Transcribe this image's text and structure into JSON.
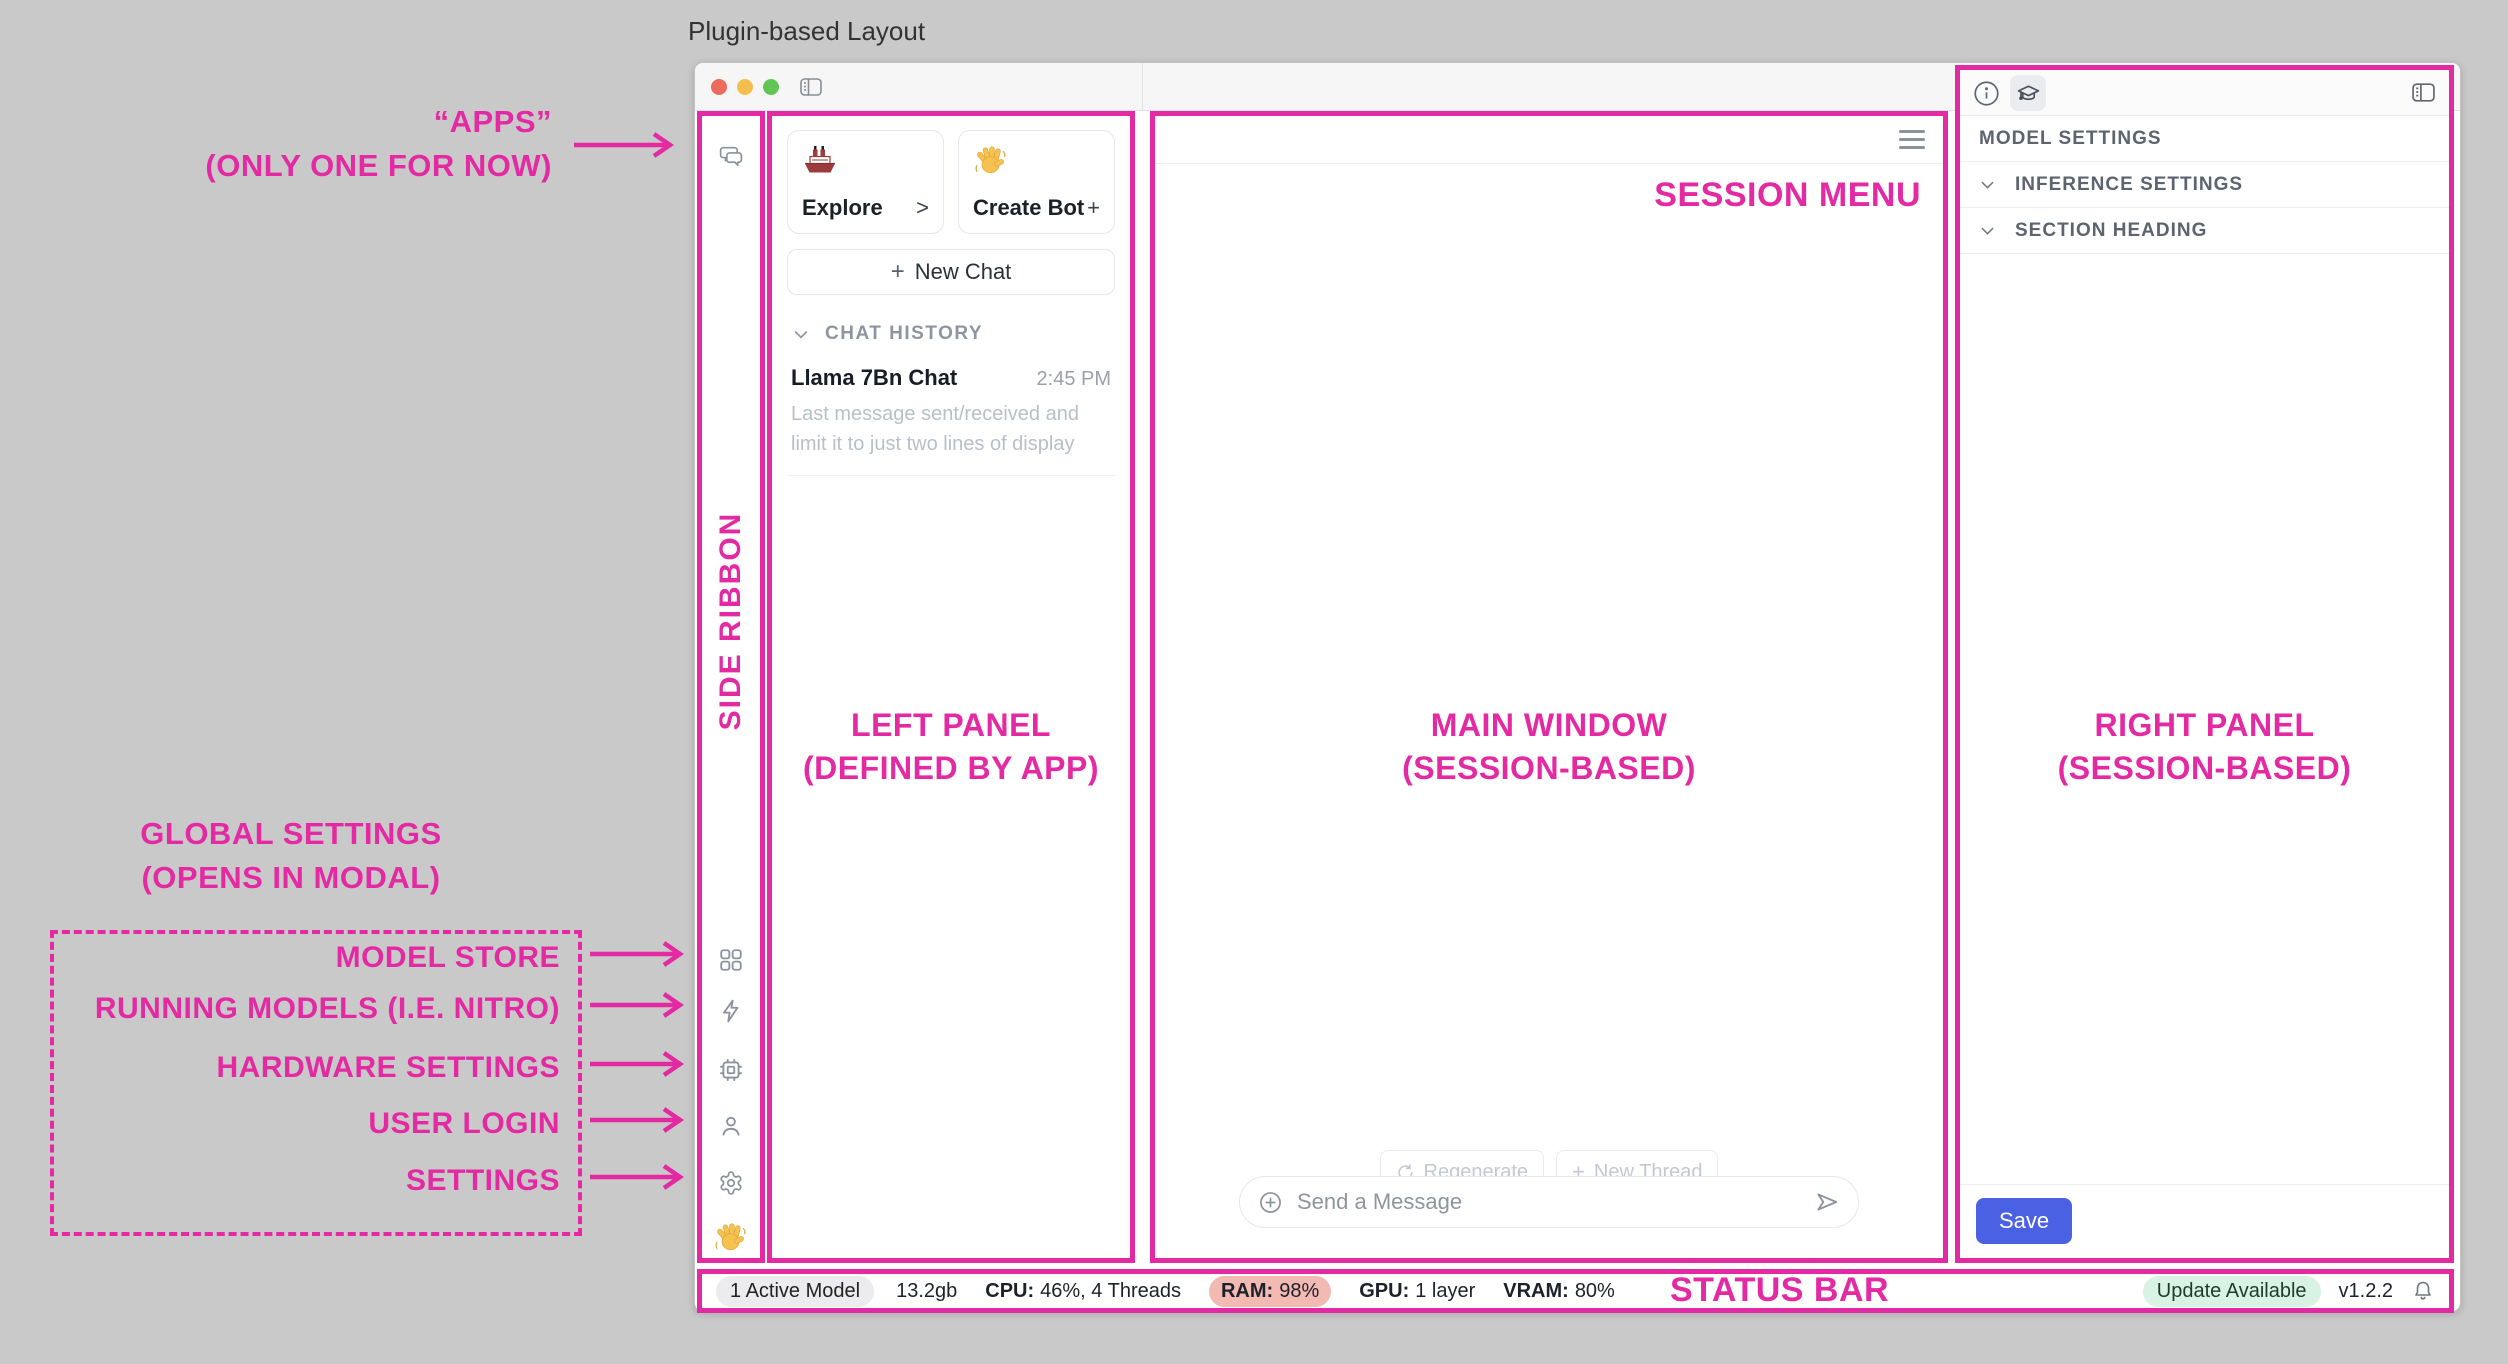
{
  "page_title": "Plugin-based Layout",
  "colors": {
    "annotation_magenta": "#e32aa2",
    "save_button_blue": "#4a61e4",
    "ram_pill_bg": "#f3b9b3",
    "update_pill_bg": "#d8f2e3",
    "traffic_red": "#ed6a5e",
    "traffic_yellow": "#f4bf4f",
    "traffic_green": "#61c554"
  },
  "annotations": {
    "apps_line1": "“APPS”",
    "apps_line2": "(ONLY ONE FOR NOW)",
    "global_title_line1": "GLOBAL SETTINGS",
    "global_title_line2": "(OPENS IN MODAL)",
    "global_items": [
      {
        "label": "MODEL STORE"
      },
      {
        "label": "RUNNING MODELS (I.E. NITRO)"
      },
      {
        "label": "HARDWARE SETTINGS"
      },
      {
        "label": "USER LOGIN"
      },
      {
        "label": "SETTINGS"
      }
    ],
    "side_ribbon": "SIDE RIBBON",
    "left_panel_line1": "LEFT PANEL",
    "left_panel_line2": "(DEFINED BY APP)",
    "main_window_line1": "MAIN WINDOW",
    "main_window_line2": "(SESSION-BASED)",
    "right_panel_line1": "RIGHT PANEL",
    "right_panel_line2": "(SESSION-BASED)",
    "session_menu": "SESSION MENU",
    "status_bar": "STATUS BAR"
  },
  "left_panel": {
    "cards": [
      {
        "icon": "ship-emoji",
        "label": "Explore",
        "action": ">"
      },
      {
        "icon": "wave-emoji",
        "label": "Create Bot",
        "action": "+"
      }
    ],
    "new_chat_plus": "+",
    "new_chat_label": "New Chat",
    "history_header": "CHAT HISTORY",
    "history": [
      {
        "title": "Llama 7Bn Chat",
        "time": "2:45 PM",
        "preview": "Last message sent/received and limit it to just two lines of display"
      }
    ]
  },
  "main_window": {
    "regenerate_label": "Regenerate",
    "new_thread_plus": "+",
    "new_thread_label": "New Thread",
    "composer_placeholder": "Send a Message"
  },
  "right_panel": {
    "sections": [
      {
        "label": "MODEL SETTINGS"
      },
      {
        "label": "INFERENCE SETTINGS"
      },
      {
        "label": "SECTION HEADING"
      }
    ],
    "save_label": "Save"
  },
  "status_bar": {
    "active_model": "1 Active Model",
    "memory": "13.2gb",
    "cpu_label": "CPU:",
    "cpu_value": "46%, 4 Threads",
    "ram_label": "RAM:",
    "ram_value": "98%",
    "gpu_label": "GPU:",
    "gpu_value": "1 layer",
    "vram_label": "VRAM:",
    "vram_value": "80%",
    "update_badge": "Update Available",
    "version": "v1.2.2"
  }
}
